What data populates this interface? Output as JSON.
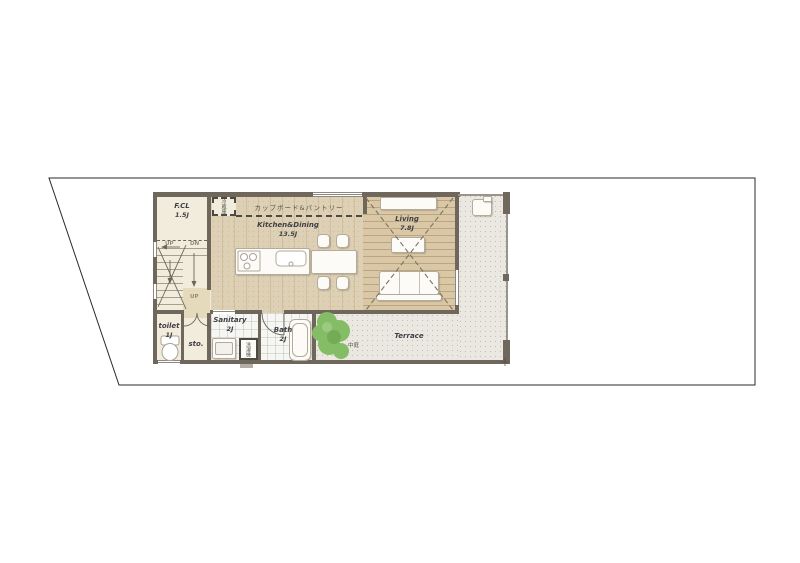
{
  "colors": {
    "wall": "#6f665c",
    "wood": "#d9c7a5",
    "kitchen": "#ddd0b4",
    "cream": "#f2ecdc",
    "hall": "#e6dabd",
    "tile": "#f6f6f2",
    "terrace": "#eae8e0",
    "plant": "#85bd66",
    "boundary": "#2a2a2a",
    "label": "#3e3f49"
  },
  "rooms": {
    "fcl": {
      "name": "F.CL",
      "size": "1.5J"
    },
    "kitchen_dining": {
      "name": "Kitchen&Dining",
      "size": "13.5J"
    },
    "living": {
      "name": "Living",
      "size": "7.8J"
    },
    "toilet": {
      "name": "toilet",
      "size": "1J"
    },
    "storage": {
      "name": "sto."
    },
    "sanitary": {
      "name": "Sanitary",
      "size": "2J"
    },
    "bath": {
      "name": "Bath",
      "size": "2J"
    },
    "terrace": {
      "name": "Terrace"
    }
  },
  "annotations": {
    "cupboard_pantry": "カップボード&パントリー",
    "refrigerator": "冷蔵庫",
    "washing_machine": "洗濯機",
    "courtyard": "中庭"
  },
  "stairs": {
    "up": "UP",
    "down": "DN",
    "hall_up": "UP"
  }
}
